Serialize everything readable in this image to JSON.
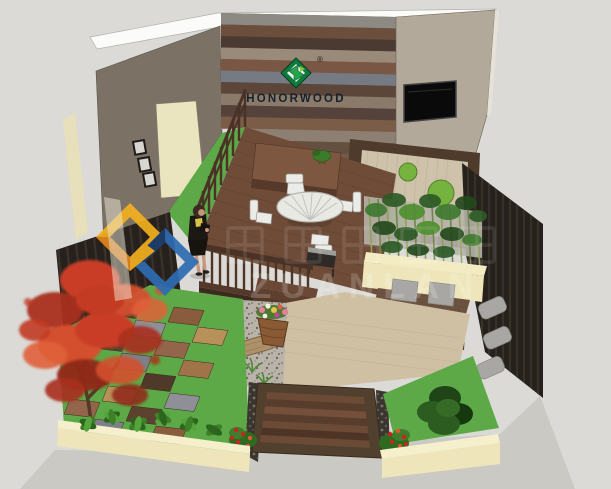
{
  "brand": {
    "logo_text": "HONORWOOD",
    "registered_mark": "®"
  },
  "watermark": {
    "pinyin_text": "ZUANLAN"
  },
  "icons": {
    "honorwood-logo-icon": "green cube monogram",
    "watermark-logo-icon": "interlocked blue and yellow diamond rings"
  },
  "palette": {
    "background": "#dbdad6",
    "concrete": "#cac9c4",
    "wall_white_top": "#fbfbf9",
    "wall_taupe": "#7b7265",
    "wall_beige": "#b3a99a",
    "door_cream": "#eae4bf",
    "tv_black": "#0a0a0a",
    "deck_brown": "#6f4c38",
    "railing_brown": "#4a3226",
    "grass_green": "#5da947",
    "zen_floor": "#cfc2ab",
    "zen_moss": "#76b23e",
    "planter_cream": "#eee6ba",
    "bamboo_foliage": "#3f7a30",
    "maple_red": "#c93d26",
    "patio_beige": "#cfc0a4",
    "gravel": "#b9b3a9",
    "walkway_brown": "#52402f",
    "fence_dark": "#26211c",
    "cushion_gray": "#a8a7a3",
    "flower_red": "#cc2418",
    "table_white": "#e9e9e4",
    "watermark_blue": "#2e6cb2",
    "watermark_yellow": "#f2b01e",
    "logo_green": "#0e7a3e"
  }
}
